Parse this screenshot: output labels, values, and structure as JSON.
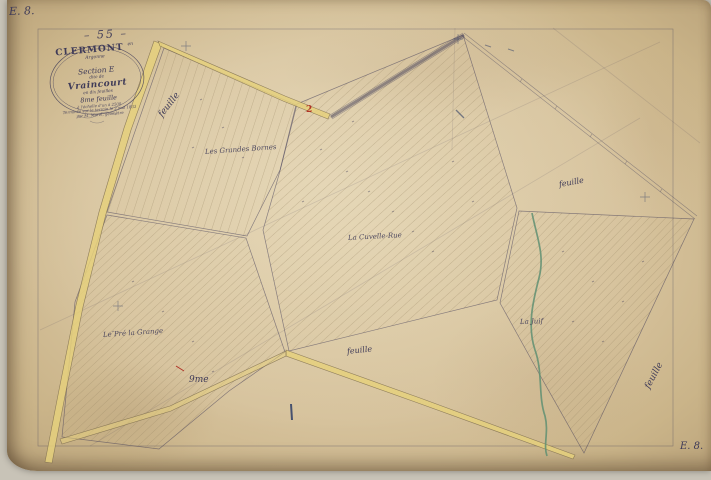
{
  "colors": {
    "ink": "#3f3b58",
    "road": "#e5d07d",
    "stream": "#5f8f72",
    "red": "#b03226",
    "blue": "#2e3d66"
  },
  "sheet_stamp": "– 55 –",
  "corner_labels": {
    "top_left": "E. 8.",
    "bottom_right": "E. 8."
  },
  "cartouche": {
    "commune": "CLERMONT",
    "commune_suffix": "en Argonne",
    "section": "Section E",
    "dite": "dite de",
    "lieu": "Vraincourt",
    "feuilles_note": "en dix feuilles",
    "feuille_num": "8me feuille",
    "echelle": "à l'échelle d'un à 2500",
    "terminee": "Terminée sur le terrain le 2 mai 1833",
    "geometre": "par M. Morel, géomètre"
  },
  "feuille_labels": {
    "f1": "feuille",
    "f2": "feuille",
    "f3": "feuille",
    "f4": "feuille"
  },
  "place_labels": {
    "granges": "Les Grandes Bornes",
    "cuvelle": "La Cuvelle-Rue",
    "juif": "La Juif",
    "pre_grange": "Le Pré la Grange",
    "neuvieme": "9me",
    "parcel_red": "2"
  }
}
